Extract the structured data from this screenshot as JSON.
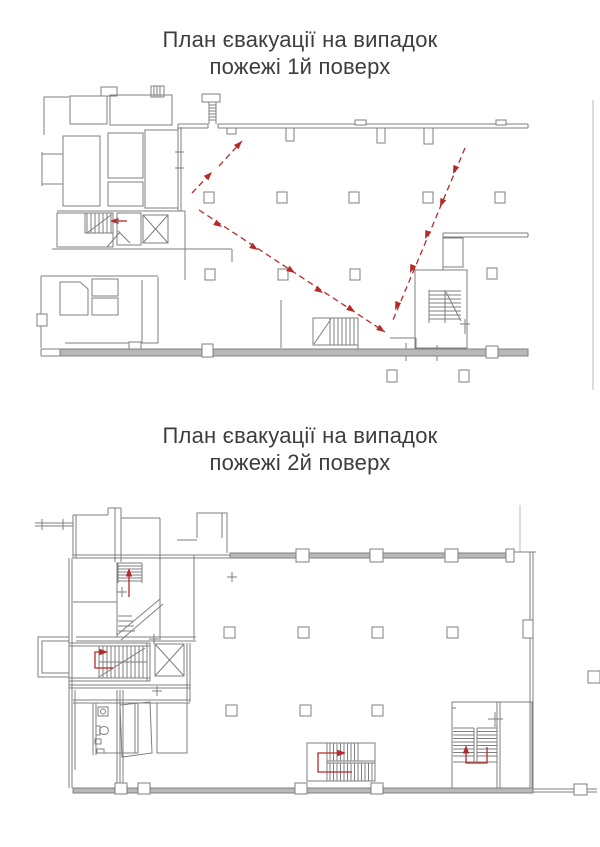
{
  "document": {
    "type": "fire-evacuation-plan-poster",
    "language": "uk",
    "floor1": {
      "title_line1": "План євакуації на випадок",
      "title_line2": "пожежі 1й поверх"
    },
    "floor2": {
      "title_line1": "План євакуації на випадок",
      "title_line2": "пожежі 2й поверх"
    },
    "colors": {
      "wall_line": "#7f7f7f",
      "wall_fill": "#b8b8b8",
      "evacuation_arrow": "#b52b2b",
      "title_text": "#3d3d3d",
      "boundary_line": "#c6c6c6",
      "page_bg": "#ffffff"
    },
    "icons": {
      "staircase-icon": "hatched-tread-lines-with-diagonal",
      "elevator-icon": "x-crossed-box",
      "column-icon": "small-hollow-square",
      "evacuation-arrow-icon": "red-arrow",
      "toilet-icon": "bowl-with-tank"
    }
  }
}
